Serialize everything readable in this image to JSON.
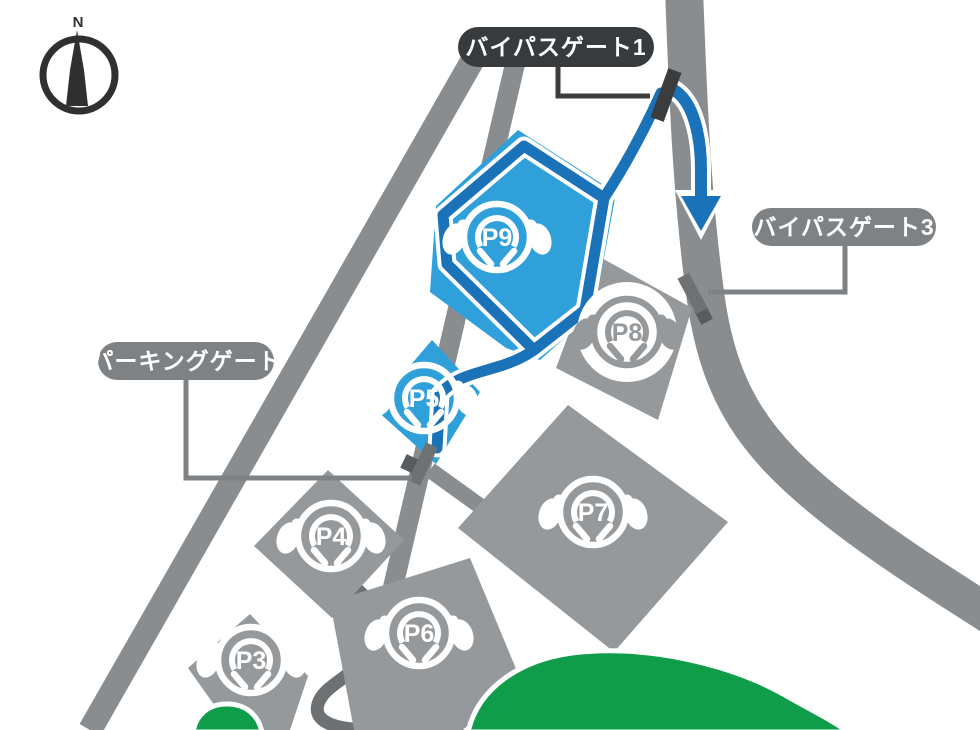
{
  "map": {
    "compass_label": "N",
    "labels": {
      "bypass_gate_1": "バイパスゲート1",
      "bypass_gate_3": "バイパスゲート3",
      "parking_gate": "パーキングゲート"
    },
    "parking_lots": [
      {
        "id": "P9",
        "highlighted": true
      },
      {
        "id": "P5",
        "highlighted": true
      },
      {
        "id": "P8",
        "highlighted": false
      },
      {
        "id": "P7",
        "highlighted": false
      },
      {
        "id": "P4",
        "highlighted": false
      },
      {
        "id": "P6",
        "highlighted": false
      },
      {
        "id": "P3",
        "highlighted": false
      }
    ],
    "colors": {
      "road_gray": "#8A8D90",
      "lot_gray": "#96999C",
      "dark_road_gray": "#6E7173",
      "highlight_blue": "#2FA0DA",
      "route_blue": "#1A72B8",
      "green": "#0F9D49",
      "pill_gray": "#7F8285",
      "pill_dark": "#383B3D",
      "gate_dark": "#3A3C3E",
      "gate_gray": "#6F7274"
    }
  }
}
